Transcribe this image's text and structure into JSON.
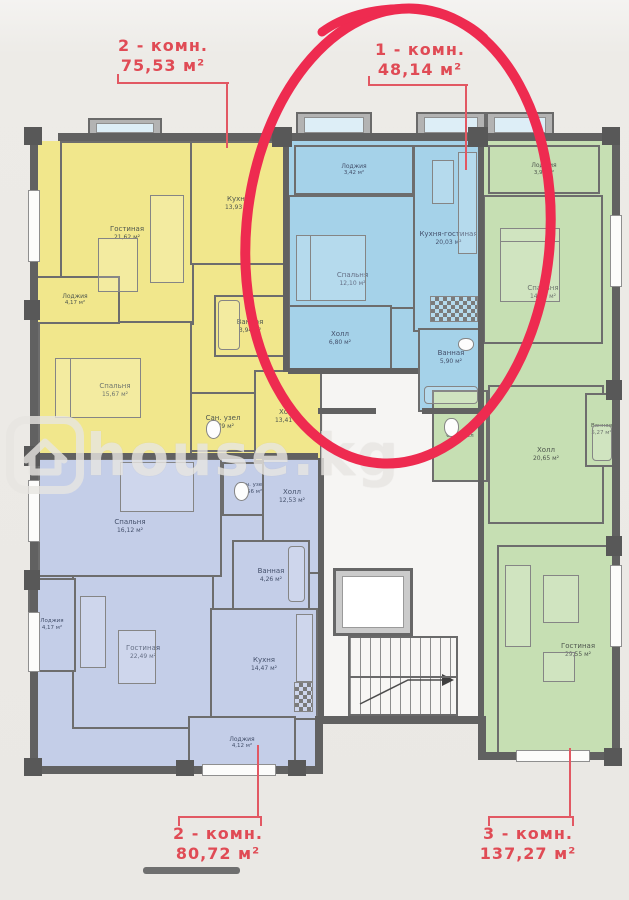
{
  "page": {
    "background": "#edebe7"
  },
  "watermark": {
    "text": "house.kg"
  },
  "highlight": {
    "circle_color": "#ee2b50"
  },
  "unit_labels": {
    "top_left": {
      "type": "2 - комн.",
      "area": "75,53 м²"
    },
    "top_right": {
      "type": "1 - комн.",
      "area": "48,14 м²"
    },
    "bottom_left": {
      "type": "2 - комн.",
      "area": "80,72 м²"
    },
    "bottom_right": {
      "type": "3 - комн.",
      "area": "137,27 м²"
    }
  },
  "apartments": {
    "yellow_2room": {
      "fill": "#f1e78c",
      "rooms": {
        "gostinaya": {
          "name": "Гостиная",
          "area": "21,62 м²"
        },
        "kuhnya": {
          "name": "Кухня",
          "area": "13,93 м²"
        },
        "vannaya": {
          "name": "Ванная",
          "area": "3,94 м²"
        },
        "sanuzel": {
          "name": "Сан. узел",
          "area": "2,79 м²"
        },
        "holl": {
          "name": "Холл",
          "area": "13,41 м²"
        },
        "spalnya": {
          "name": "Спальня",
          "area": "15,67 м²"
        },
        "lodzhiya": {
          "name": "Лоджия",
          "area": "4,17 м²"
        }
      }
    },
    "blue_1room": {
      "fill": "#a5d2e9",
      "rooms": {
        "lodzhiya": {
          "name": "Лоджия",
          "area": "3,42 м²"
        },
        "spalnya": {
          "name": "Спальня",
          "area": "12,10 м²"
        },
        "kuhnya_gostinaya": {
          "name": "Кухня-гостиная",
          "area": "20,03 м²"
        },
        "holl": {
          "name": "Холл",
          "area": "6,80 м²"
        },
        "vannaya": {
          "name": "Ванная",
          "area": "5,90 м²"
        }
      }
    },
    "green_3room": {
      "fill": "#c6dfb3",
      "rooms": {
        "lodzhiya": {
          "name": "Лоджия",
          "area": "3,99 м²"
        },
        "spalnya": {
          "name": "Спальня",
          "area": "14,40 м²"
        },
        "holl": {
          "name": "Холл",
          "area": "20,65 м²"
        },
        "vannaya": {
          "name": "Ванная",
          "area": "5,27 м²"
        },
        "sanuzel": {
          "name": "Сан. узел",
          "area": ""
        },
        "gostinaya": {
          "name": "Гостиная",
          "area": "29,55 м²"
        }
      }
    },
    "periwinkle_2room": {
      "fill": "#c4cee8",
      "rooms": {
        "spalnya": {
          "name": "Спальня",
          "area": "16,12 м²"
        },
        "sanuzel": {
          "name": "Сан. узел",
          "area": "2,56 м²"
        },
        "holl": {
          "name": "Холл",
          "area": "12,53 м²"
        },
        "vannaya": {
          "name": "Ванная",
          "area": "4,26 м²"
        },
        "gostinaya": {
          "name": "Гостиная",
          "area": "22,49 м²"
        },
        "kuhnya": {
          "name": "Кухня",
          "area": "14,47 м²"
        },
        "lodzhiya_left": {
          "name": "Лоджия",
          "area": "4,17 м²"
        },
        "lodzhiya_bottom": {
          "name": "Лоджия",
          "area": "4,12 м²"
        }
      }
    }
  }
}
